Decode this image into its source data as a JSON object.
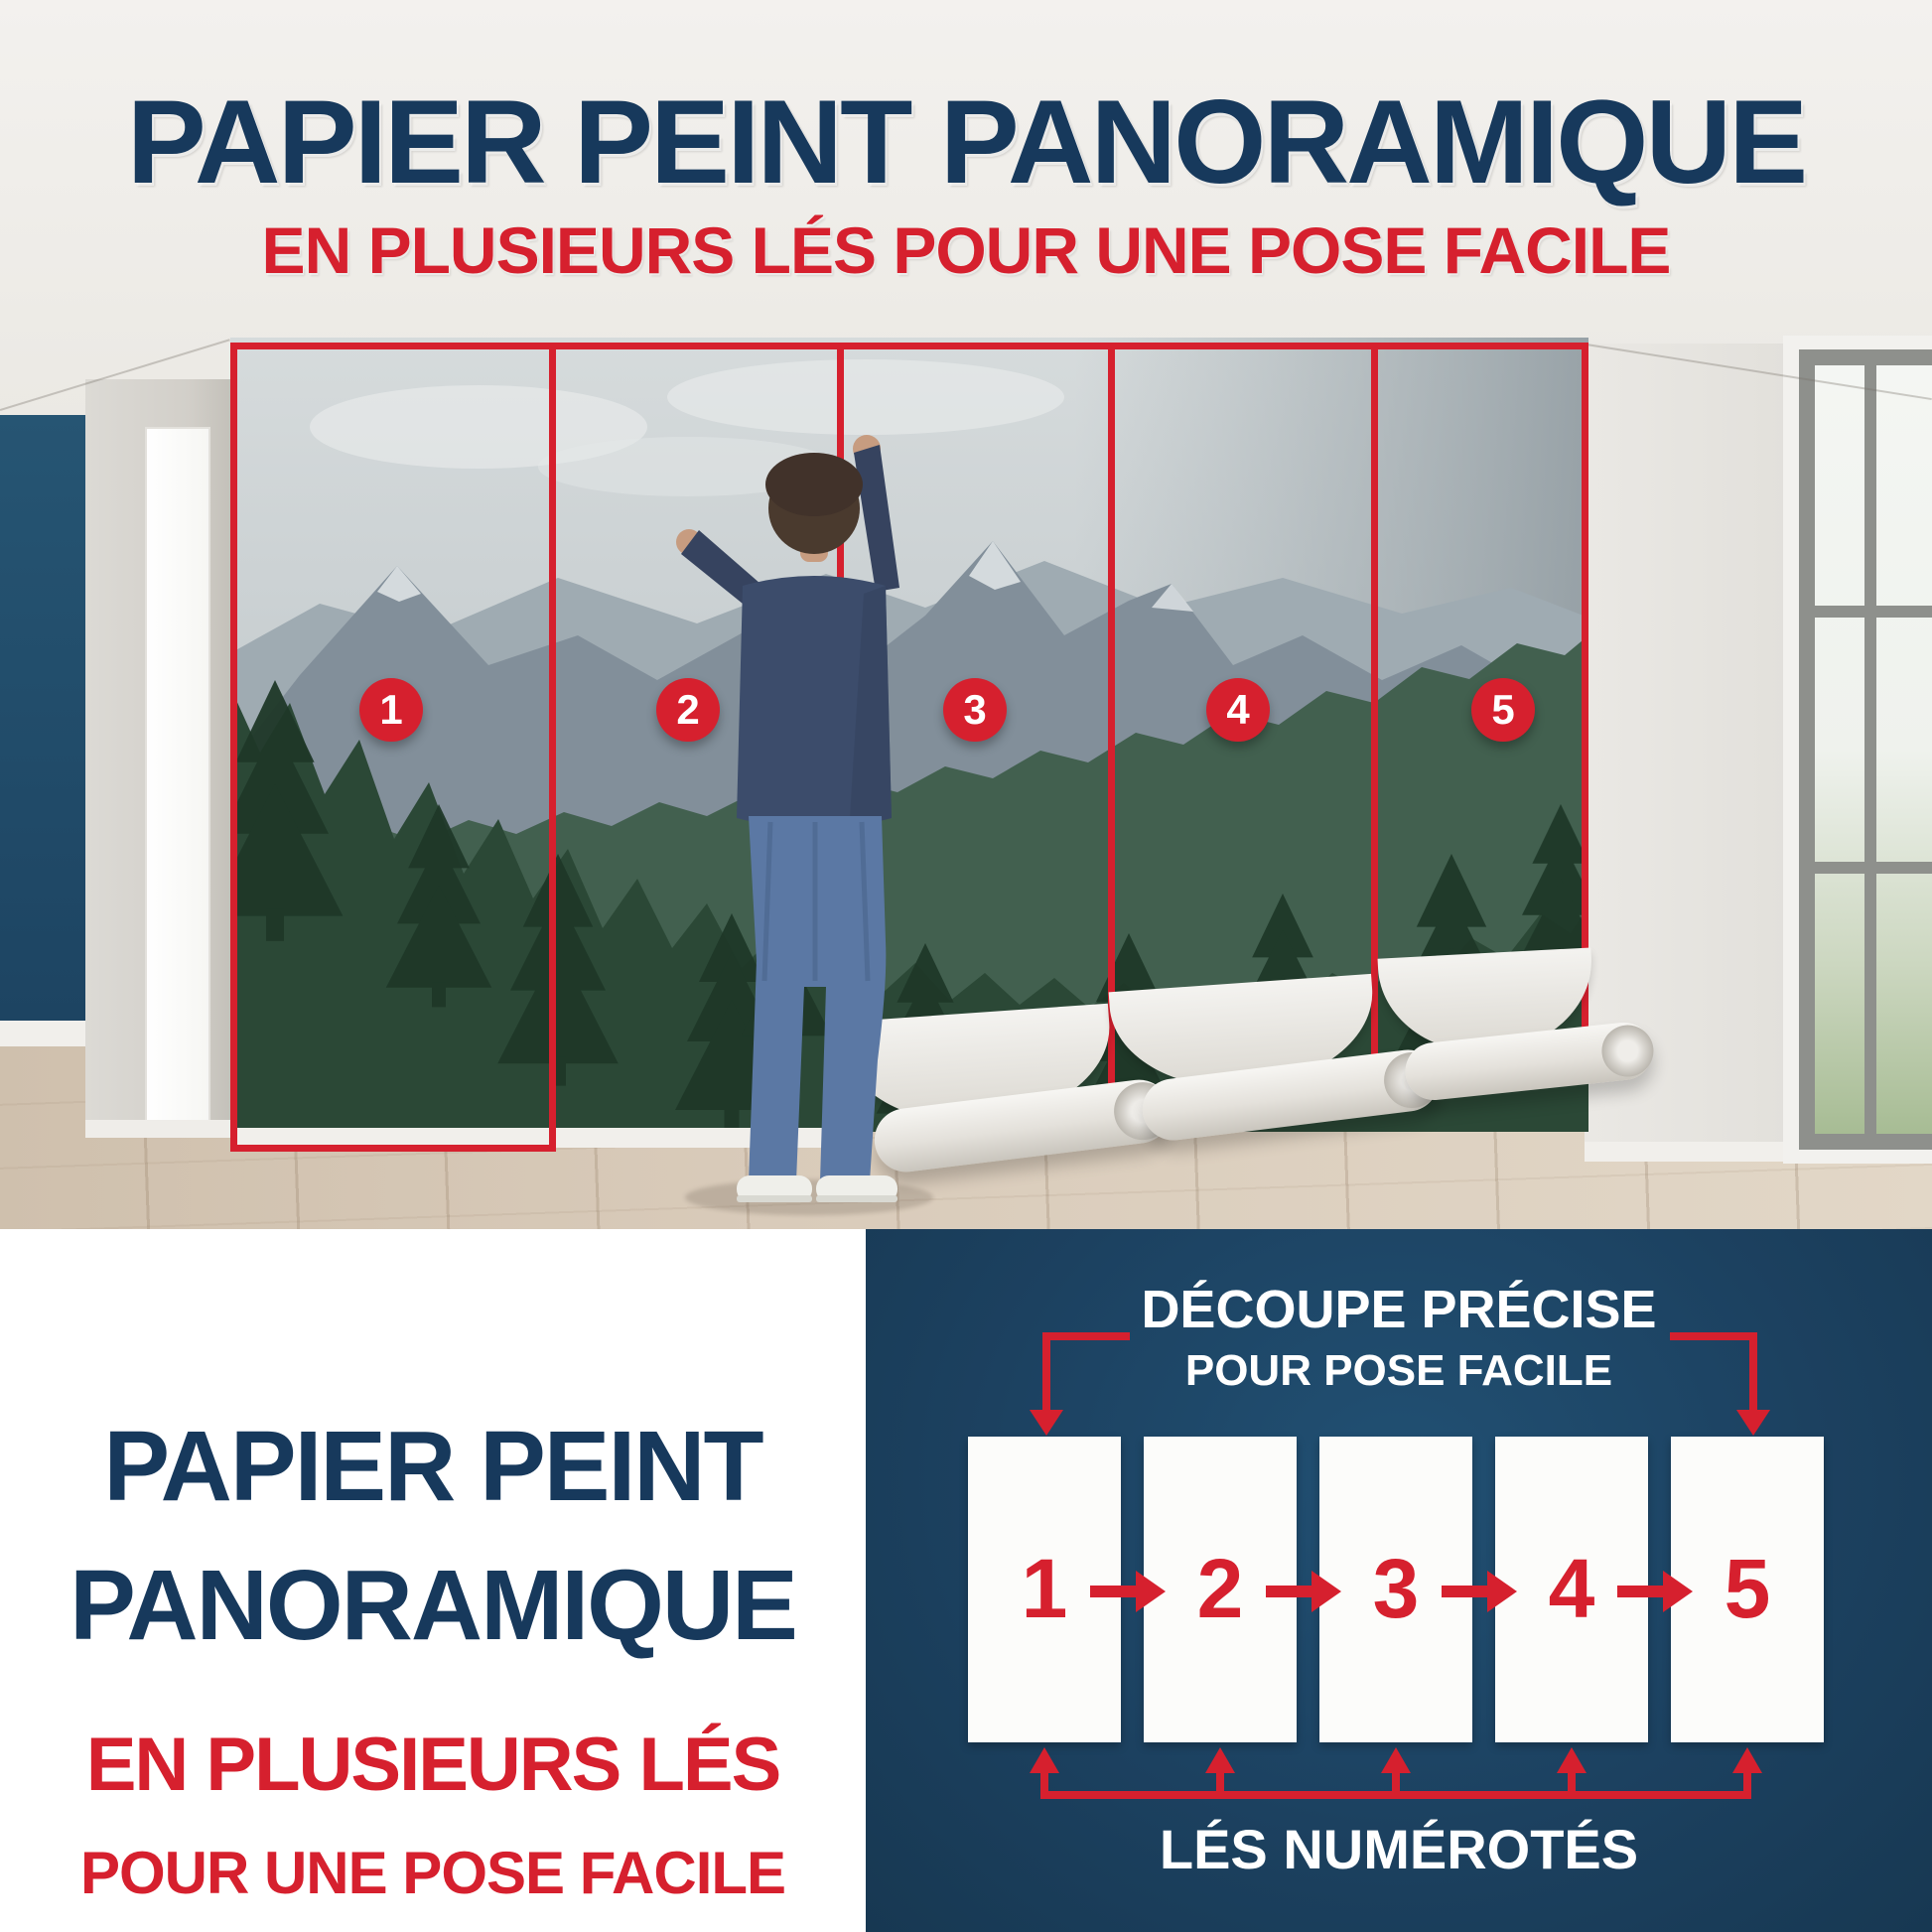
{
  "header": {
    "title": "PAPIER PEINT PANORAMIQUE",
    "subtitle": "EN PLUSIEURS LÉS POUR UNE POSE FACILE"
  },
  "photo": {
    "strip_numbers": [
      "1",
      "2",
      "3",
      "4",
      "5"
    ]
  },
  "bottom_left": {
    "title_line1": "PAPIER PEINT",
    "title_line2": "PANORAMIQUE",
    "subtitle_line1": "EN PLUSIEURS LÉS",
    "subtitle_line2": "POUR UNE POSE FACILE"
  },
  "bottom_right": {
    "heading_line1": "DÉCOUPE PRÉCISE",
    "heading_line2": "POUR POSE FACILE",
    "strip_numbers": [
      "1",
      "2",
      "3",
      "4",
      "5"
    ],
    "caption": "LÉS NUMÉROTÉS"
  },
  "colors": {
    "red_accent": "#d6202e",
    "navy_text": "#17395c",
    "diagram_background": "#1c4160",
    "accent_wall_blue": "#21506e"
  }
}
